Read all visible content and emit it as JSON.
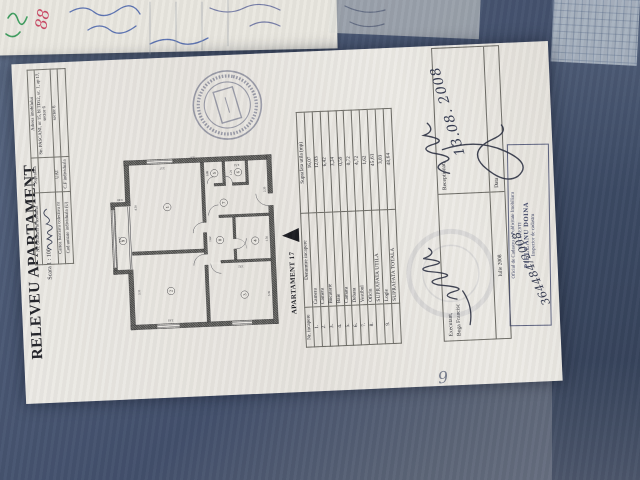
{
  "document": {
    "title": "RELEVEU APARTAMENT",
    "scale": "Scara 1 : 100",
    "cad_table": {
      "rows": [
        [
          "Nr. cadastral al terenului",
          "Suprafata",
          "Adresa imobilului"
        ],
        [
          "",
          "",
          "Str. PASCANI, nr 15, bl TD12, sc. 1, ap 17, sector 6"
        ],
        [
          "Cartea funciara colectiva nr",
          "UAT",
          "sector 6"
        ],
        [
          "Cod unitate individuala (U)",
          "C.F individuala",
          ""
        ]
      ]
    },
    "plan": {
      "caption": "APARTAMENT 17",
      "rooms": [
        {
          "n": "1",
          "x": 368,
          "y": 175
        },
        {
          "n": "2",
          "x": 120,
          "y": 175
        },
        {
          "n": "3",
          "x": 100,
          "y": 392
        },
        {
          "n": "4",
          "x": 258,
          "y": 430
        },
        {
          "n": "5",
          "x": 462,
          "y": 318
        },
        {
          "n": "6",
          "x": 462,
          "y": 388
        },
        {
          "n": "7",
          "x": 374,
          "y": 342
        },
        {
          "n": "8",
          "x": 264,
          "y": 326
        },
        {
          "n": "9",
          "x": 274,
          "y": 40
        }
      ],
      "dims": [
        {
          "v": "3.31",
          "x": 120,
          "y": 84,
          "r": 0
        },
        {
          "v": "3.37",
          "x": 278,
          "y": 34,
          "r": 0
        },
        {
          "v": "4.50",
          "x": 370,
          "y": 84,
          "r": 0
        },
        {
          "v": "3.63",
          "x": 36,
          "y": 170,
          "r": -90
        },
        {
          "v": "3.57",
          "x": 486,
          "y": 165,
          "r": -90
        },
        {
          "v": "0.90",
          "x": 398,
          "y": 36,
          "r": -90
        },
        {
          "v": "2.51",
          "x": 486,
          "y": 385,
          "r": -90
        },
        {
          "v": "5.97",
          "x": 514,
          "y": 255,
          "r": -90
        },
        {
          "v": "3.35",
          "x": 100,
          "y": 467,
          "r": 0
        },
        {
          "v": "1.92",
          "x": 186,
          "y": 385,
          "r": -90
        },
        {
          "v": "1.50",
          "x": 262,
          "y": 467,
          "r": 0
        },
        {
          "v": "2.20",
          "x": 408,
          "y": 467,
          "r": 0
        },
        {
          "v": "0.86",
          "x": 462,
          "y": 300,
          "r": 0
        },
        {
          "v": "1.21",
          "x": 462,
          "y": 370,
          "r": 0
        },
        {
          "v": "1.62",
          "x": 268,
          "y": 300,
          "r": 0
        }
      ]
    },
    "room_table": {
      "headers": [
        "Nr. incapere",
        "Denumire incapere",
        "Suprafata utila (mp)"
      ],
      "rows": [
        [
          "1.",
          "Camera",
          "16,07"
        ],
        [
          "2.",
          "Camera",
          "12,03"
        ],
        [
          "3.",
          "Bucatarie",
          "6,42"
        ],
        [
          "4.",
          "Baie",
          "3,24"
        ],
        [
          "5.",
          "Camara",
          "0,59"
        ],
        [
          "6.",
          "Debara",
          "0,72"
        ],
        [
          "7.",
          "Vestibul",
          "4,72"
        ],
        [
          "8.",
          "Oficiu",
          "1,62"
        ],
        [
          "",
          "SUPRAFATA UTILA",
          "45,61"
        ],
        [
          "9.",
          "Logie",
          "3,03"
        ],
        [
          "",
          "SUPRAFATA TOTALA",
          "48,64"
        ]
      ]
    },
    "footer": {
      "executant_label": "Executant,",
      "executant_name": "Boga Francisc",
      "executant_date": "Iulie 2008",
      "receptionat_label": "Receptionat,",
      "data_label": "Data",
      "handwritten_date": "13.08. 2008",
      "registration_number": "364484/2008"
    },
    "stamp_box": {
      "lines": [
        "Oficiul de Cadastru si Publicitate Imobiliara",
        "BUCURESTI",
        "PIELEANU DOINA",
        "Inspector de cadastru"
      ]
    },
    "corner_mark": "6"
  }
}
